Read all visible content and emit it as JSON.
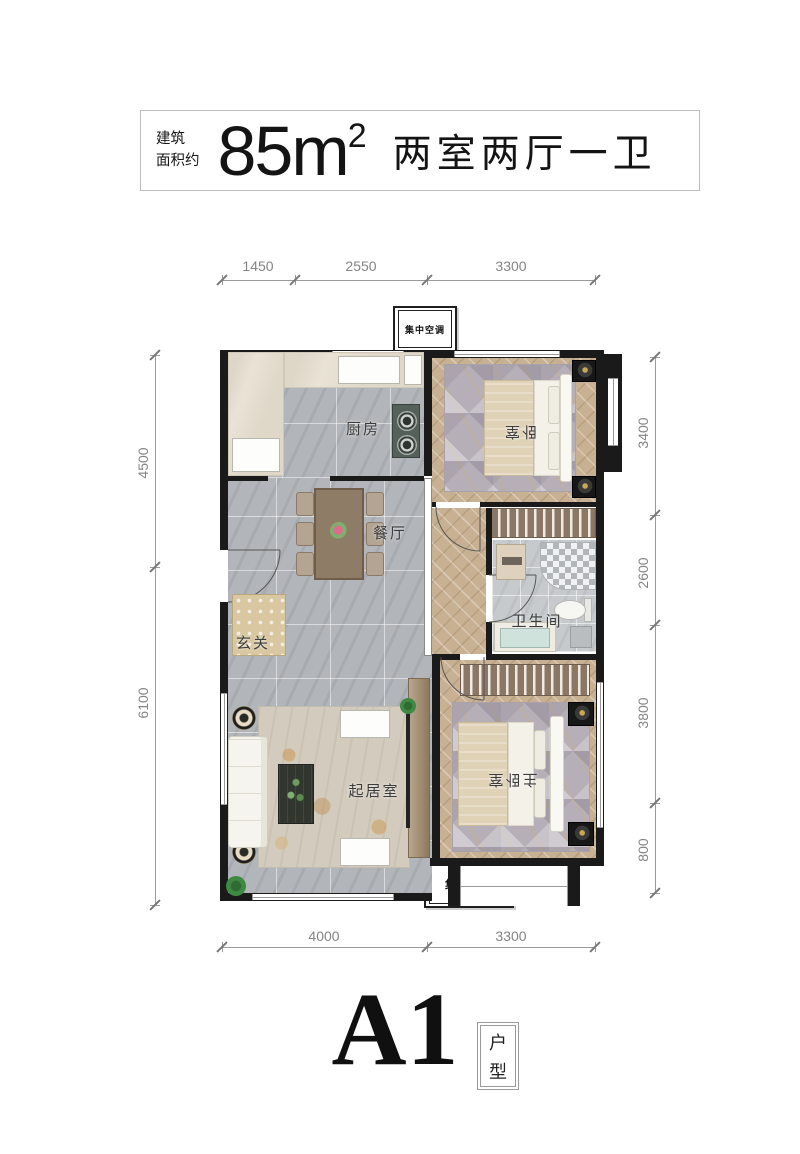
{
  "header": {
    "area_prefix_line1": "建筑",
    "area_prefix_line2": "面积约",
    "area_number": "85",
    "area_unit": "m",
    "area_exponent": "2",
    "layout_summary": "两室两厅一卫"
  },
  "plan": {
    "rooms": {
      "kitchen": "厨房",
      "bedroom": "卧室",
      "dining": "餐厅",
      "bathroom": "卫生间",
      "entry": "玄关",
      "living": "起居室",
      "master_bedroom": "主卧室"
    },
    "hvac_top": "集中空调",
    "hvac_bottom": "集中空调"
  },
  "dimensions": {
    "top": [
      "1450",
      "2550",
      "3300"
    ],
    "bottom": [
      "4000",
      "3300"
    ],
    "left": [
      "4500",
      "6100"
    ],
    "right": [
      "3400",
      "2600",
      "3800",
      "800"
    ]
  },
  "footer": {
    "unit_name": "A1",
    "unit_char1": "户",
    "unit_char2": "型"
  },
  "colors": {
    "wall": "#1a1a1a",
    "tile_floor": "#b2b6ba",
    "wood_floor": "#c8b193",
    "dimension_text": "#848484"
  }
}
